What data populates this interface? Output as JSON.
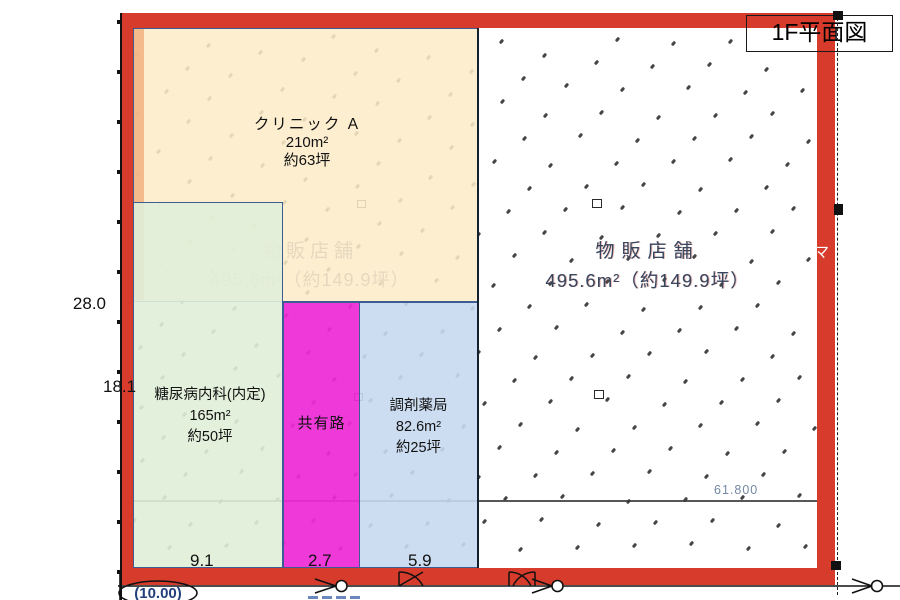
{
  "title": "1F平面図",
  "zones": {
    "clinic": {
      "name": "クリニック A",
      "area": "210m²",
      "tsubo": "約63坪"
    },
    "internal": {
      "name": "糖尿病内科(内定)",
      "area": "165m²",
      "tsubo": "約50坪"
    },
    "shared": {
      "name": "共有路"
    },
    "pharmacy": {
      "name": "調剤薬局",
      "area": "82.6m²",
      "tsubo": "約25坪"
    },
    "retail": {
      "name": "物販店舗",
      "area_line": "495.6m²（約149.9坪）"
    }
  },
  "ghost": {
    "name": "物販店舗",
    "area_line": "495.6m²（約149.9坪）"
  },
  "dimensions": {
    "left_total": "28.0",
    "left_partial": "18.1",
    "bottom_internal": "9.1",
    "bottom_shared": "2.7",
    "bottom_pharmacy": "5.9",
    "site_width": "61.800",
    "bottom_left": "(10.00)"
  },
  "fragments": {
    "band_char1": "マ",
    "band_char2": "）"
  },
  "colors": {
    "frame_red": "#d63b2b",
    "clinic_fill": "#fdecc9",
    "clinic_strip": "#f3ad7a",
    "internal_fill": "#e2eeda",
    "shared_fill": "#ee2ad6",
    "pharmacy_fill": "#c5d8ee",
    "zone_border": "#3c5d94",
    "ghost_text": "#2d4164",
    "survey_blue": "#23407c"
  }
}
